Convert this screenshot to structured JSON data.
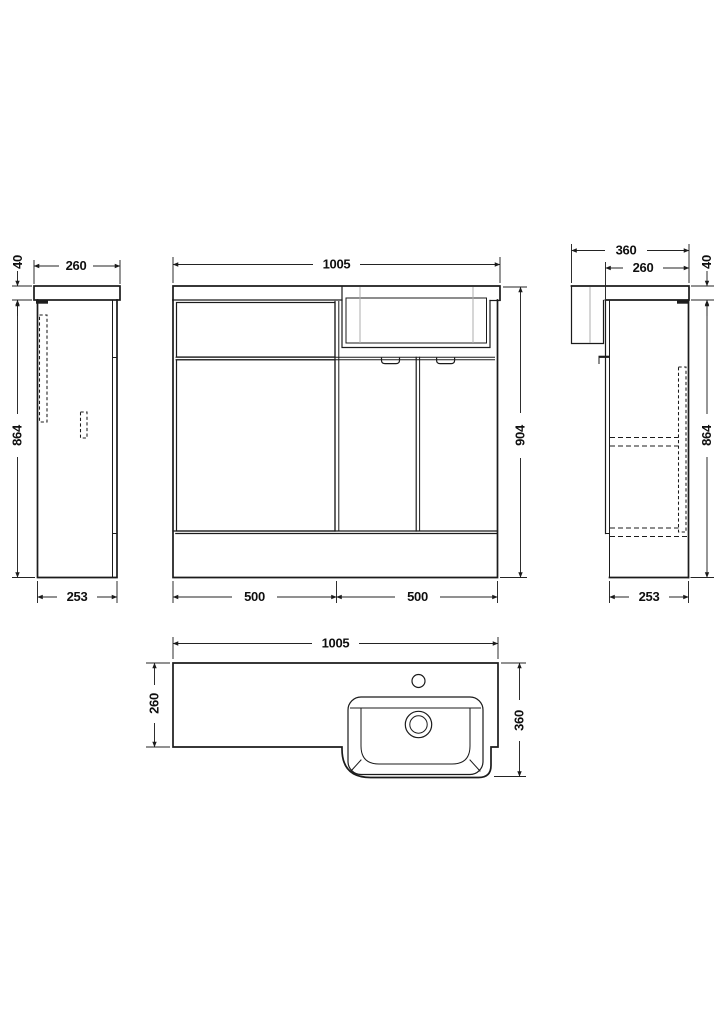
{
  "drawing": {
    "kind": "technical dimension drawing",
    "subject": "combination vanity basin unit - orthographic views",
    "units": "mm",
    "background_color": "#ffffff",
    "line_color": "#1b1b1b"
  },
  "dims": {
    "left_view": {
      "top_thickness": "40",
      "top_depth": "260",
      "body_height": "864",
      "base_depth": "253"
    },
    "front_view": {
      "overall_width": "1005",
      "overall_height": "904",
      "left_section_width": "500",
      "right_section_width": "500"
    },
    "right_view": {
      "overall_depth": "360",
      "top_depth": "260",
      "top_thickness": "40",
      "body_height": "864",
      "base_depth": "253"
    },
    "plan_view": {
      "overall_width": "1005",
      "counter_depth": "260",
      "basin_depth": "360"
    }
  }
}
